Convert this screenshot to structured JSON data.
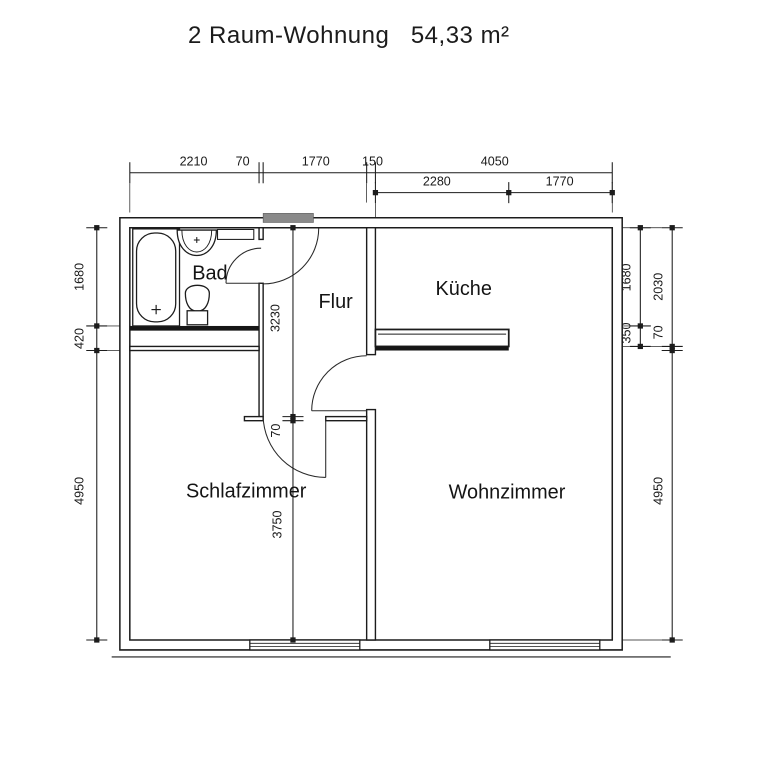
{
  "title": "2 Raum-Wohnung   54,33 m²",
  "plan": {
    "unit": "mm",
    "area_label": "54,33 m²",
    "rooms": [
      {
        "name": "Bad",
        "label_x": 1370,
        "label_y": 890
      },
      {
        "name": "Flur",
        "label_x": 3520,
        "label_y": 1370
      },
      {
        "name": "Küche",
        "label_x": 5710,
        "label_y": 1150
      },
      {
        "name": "Schlafzimmer",
        "label_x": 1990,
        "label_y": 4610
      },
      {
        "name": "Wohnzimmer",
        "label_x": 6450,
        "label_y": 4630
      }
    ],
    "dimensions": [
      {
        "text": "2210",
        "x": 1090,
        "y": -1060,
        "rotate": 0
      },
      {
        "text": "70",
        "x": 1930,
        "y": -1060,
        "rotate": 0
      },
      {
        "text": "1770",
        "x": 3180,
        "y": -1060,
        "rotate": 0
      },
      {
        "text": "150",
        "x": 4150,
        "y": -1060,
        "rotate": 0
      },
      {
        "text": "4050",
        "x": 6240,
        "y": -1060,
        "rotate": 0
      },
      {
        "text": "2280",
        "x": 5250,
        "y": -720,
        "rotate": 0
      },
      {
        "text": "1770",
        "x": 7350,
        "y": -720,
        "rotate": 0
      },
      {
        "text": "1680",
        "x": -790,
        "y": 840,
        "rotate": -90
      },
      {
        "text": "420",
        "x": -790,
        "y": 1895,
        "rotate": -90
      },
      {
        "text": "4950",
        "x": -790,
        "y": 4500,
        "rotate": -90
      },
      {
        "text": "1680",
        "x": 8560,
        "y": 850,
        "rotate": -90
      },
      {
        "text": "350",
        "x": 8560,
        "y": 1800,
        "rotate": -90
      },
      {
        "text": "2030",
        "x": 9110,
        "y": 1010,
        "rotate": -90
      },
      {
        "text": "70",
        "x": 9110,
        "y": 1790,
        "rotate": -90
      },
      {
        "text": "4950",
        "x": 9110,
        "y": 4500,
        "rotate": -90
      },
      {
        "text": "3230",
        "x": 2560,
        "y": 1545,
        "rotate": -90
      },
      {
        "text": "70",
        "x": 2570,
        "y": 3470,
        "rotate": -90
      },
      {
        "text": "3750",
        "x": 2590,
        "y": 5075,
        "rotate": -90
      }
    ],
    "fixtures": [
      "bathtub",
      "washbasin",
      "wall-cabinet",
      "toilet",
      "kitchen-counter"
    ],
    "doors": [
      "entrance-door",
      "bad-door",
      "schlafzimmer-door",
      "wohnzimmer-door"
    ],
    "windows": [
      "schlafzimmer-window",
      "wohnzimmer-window"
    ],
    "colors": {
      "line": "#1c1c1c",
      "door_panel": "#8a8a8a",
      "wall_fill_dark": "#161616"
    }
  }
}
